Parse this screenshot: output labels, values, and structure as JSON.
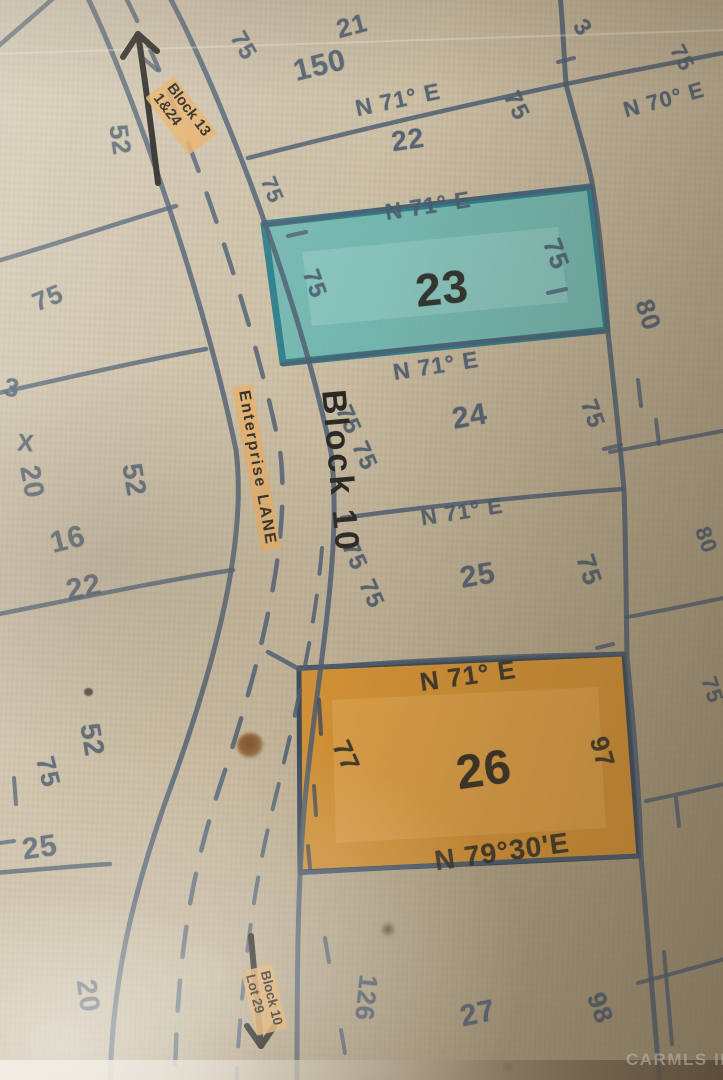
{
  "map": {
    "street_label": "Enterprise LANE",
    "block_label": "Block 10",
    "annotation_top": {
      "line1": "Block 13",
      "line2": "1&24"
    },
    "annotation_bottom": {
      "line1": "Block 10",
      "line2": "Lot 29"
    },
    "watermark": "CARMLS INC",
    "colors": {
      "paper": "#c4b79e",
      "ink": "#4b5c6f",
      "black_ink": "#292722",
      "highlight_teal": "#5fb5b2",
      "highlight_orange": "#d6902f",
      "highlighter_band": "#e7b068"
    }
  },
  "labels": [
    {
      "name": "lot-21-number",
      "text": "21"
    },
    {
      "name": "measurement-150",
      "text": "150"
    },
    {
      "name": "bearing-top",
      "text": "N 71° E"
    },
    {
      "name": "lot-22-number",
      "text": "22"
    },
    {
      "name": "measurement-75-right-of-22",
      "text": "75"
    },
    {
      "name": "measurement-75-road-top",
      "text": "75"
    },
    {
      "name": "measurement-75-left-of-22",
      "text": "75"
    },
    {
      "name": "measurement-3-top-right",
      "text": "3"
    },
    {
      "name": "measurement-75-east-top",
      "text": "75"
    },
    {
      "name": "bearing-n70e",
      "text": "N 70° E"
    },
    {
      "name": "measurement-80-east-a",
      "text": "80"
    },
    {
      "name": "bearing-lot23-top",
      "text": "N 71° E"
    },
    {
      "name": "measurement-75-lot23-left",
      "text": "75"
    },
    {
      "name": "lot-23-number",
      "text": "23"
    },
    {
      "name": "measurement-75-lot23-right",
      "text": "75"
    },
    {
      "name": "bearing-lot23-bottom",
      "text": "N 71° E"
    },
    {
      "name": "measurement-75-lot24-left-a",
      "text": "75"
    },
    {
      "name": "measurement-75-lot24-left-b",
      "text": "75"
    },
    {
      "name": "lot-24-number",
      "text": "24"
    },
    {
      "name": "measurement-75-lot24-right",
      "text": "75"
    },
    {
      "name": "bearing-lot24-bottom",
      "text": "N 71° E"
    },
    {
      "name": "measurement-75-lot25-left-a",
      "text": "75"
    },
    {
      "name": "measurement-75-lot25-left-b",
      "text": "75"
    },
    {
      "name": "lot-25-number",
      "text": "25"
    },
    {
      "name": "measurement-75-lot25-right",
      "text": "75"
    },
    {
      "name": "measurement-80-east-b",
      "text": "80"
    },
    {
      "name": "measurement-75-east-mid",
      "text": "75"
    },
    {
      "name": "bearing-lot26-top",
      "text": "N 71° E"
    },
    {
      "name": "measurement-77-lot26-left",
      "text": "77"
    },
    {
      "name": "lot-26-number",
      "text": "26"
    },
    {
      "name": "measurement-97-lot26-right",
      "text": "97"
    },
    {
      "name": "bearing-lot26-bottom",
      "text": "N 79°30'E"
    },
    {
      "name": "measurement-126",
      "text": "126"
    },
    {
      "name": "lot-27-number",
      "text": "27"
    },
    {
      "name": "measurement-98",
      "text": "98"
    },
    {
      "name": "measurement-52-left-a",
      "text": "52"
    },
    {
      "name": "measurement-75-left-a",
      "text": "75"
    },
    {
      "name": "measurement-3-left",
      "text": "3"
    },
    {
      "name": "mark-x-left",
      "text": "X"
    },
    {
      "name": "measurement-20-left-a",
      "text": "20"
    },
    {
      "name": "measurement-16-left",
      "text": "16"
    },
    {
      "name": "measurement-22-left",
      "text": "22"
    },
    {
      "name": "measurement-52-left-b",
      "text": "52"
    },
    {
      "name": "measurement-52-left-c",
      "text": "52"
    },
    {
      "name": "measurement-75-left-b",
      "text": "75"
    },
    {
      "name": "measurement-25-left",
      "text": "25"
    },
    {
      "name": "measurement-20-left-b",
      "text": "20"
    }
  ]
}
